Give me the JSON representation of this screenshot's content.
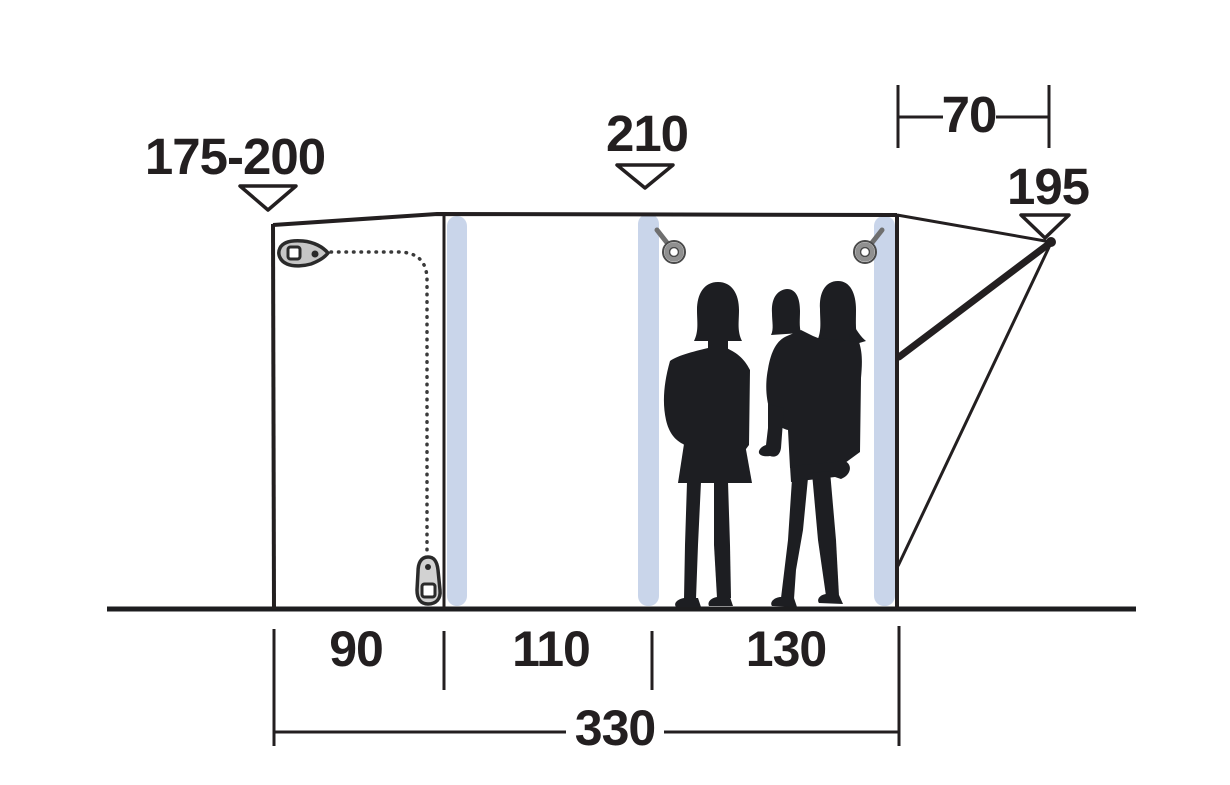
{
  "figure": {
    "type": "tent-side-profile-dimension-diagram",
    "labels": {
      "front_height": "175-200",
      "center_height": "210",
      "rear_offset": "70",
      "rear_height": "195",
      "section_1": "90",
      "section_2": "110",
      "section_3": "130",
      "total_length": "330"
    },
    "colors": {
      "line": "#231f20",
      "pole": "#c9d5ea",
      "silhouette": "#1d1e22",
      "hardware_fill": "#c6c6c6",
      "hardware_ring": "#909090",
      "background": "#ffffff"
    },
    "icons": {
      "measure_arrow": "triangle-down-arrow-icon",
      "zipper_top": "zipper-pull-icon",
      "zipper_bottom": "zipper-pull-icon",
      "toggle_left": "toggle-ring-icon",
      "toggle_right": "toggle-ring-icon"
    }
  }
}
